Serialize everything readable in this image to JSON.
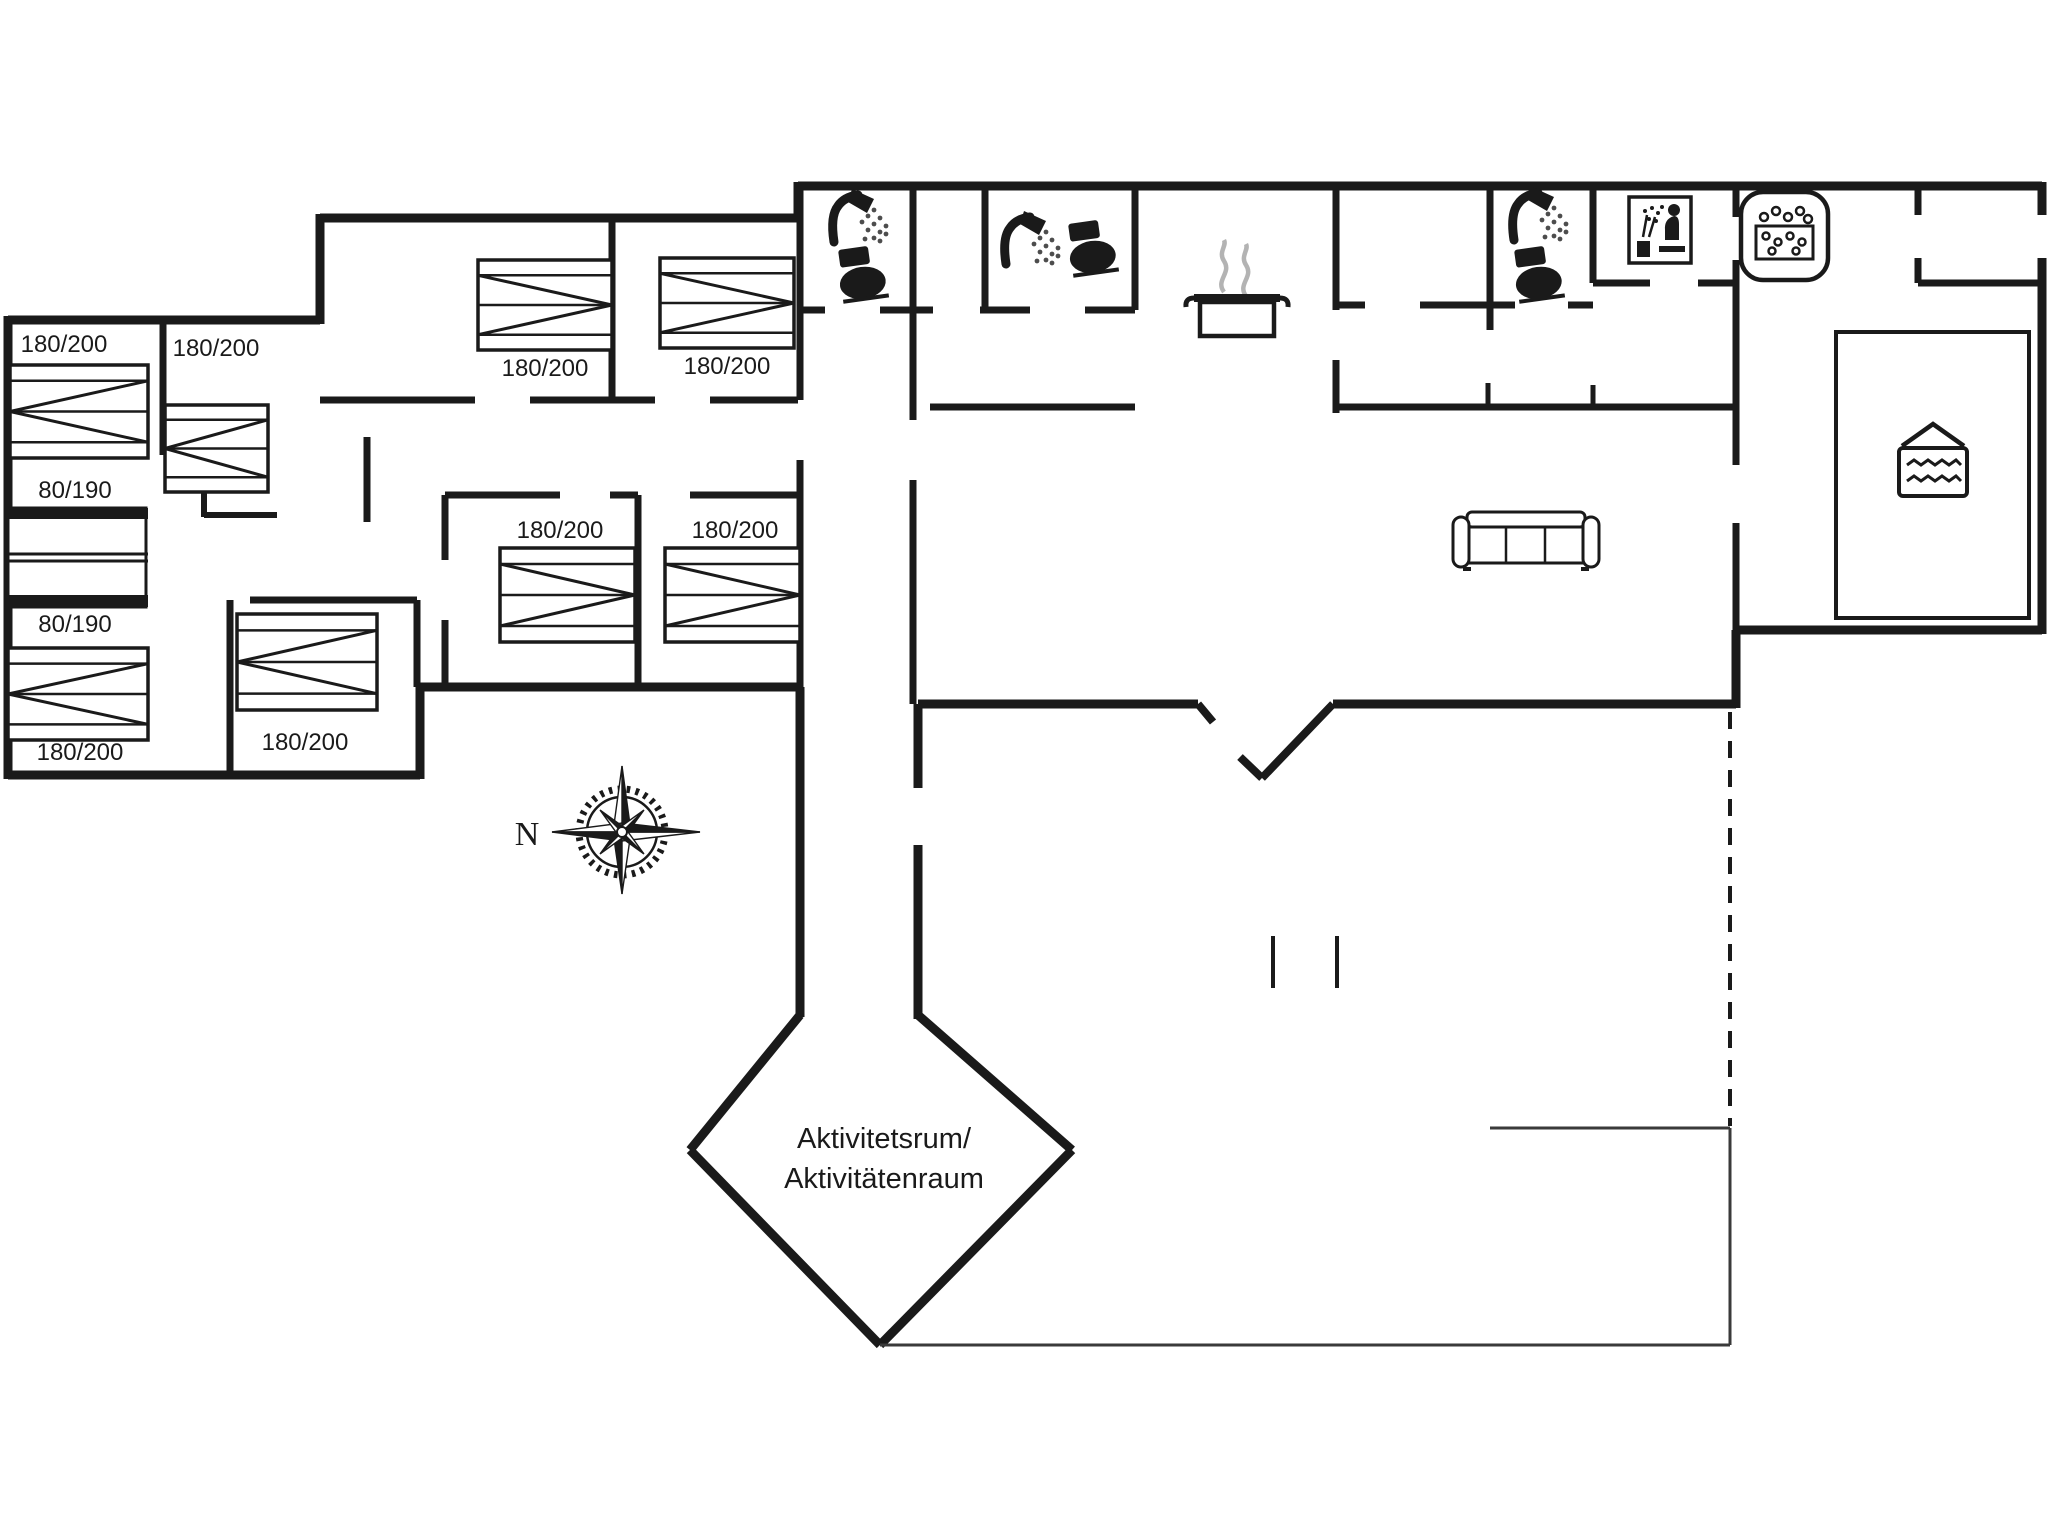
{
  "colors": {
    "ink": "#1a1a1a",
    "steam": "#b3b3b3",
    "spray": "#4d4d4d",
    "background": "#ffffff"
  },
  "labels": {
    "compass_north": "N",
    "activity_room": [
      "Aktivitetsrum/",
      "Aktivitätenraum"
    ],
    "bed_sizes": [
      {
        "text": "180/200",
        "x": 64,
        "y": 352
      },
      {
        "text": "180/200",
        "x": 216,
        "y": 356
      },
      {
        "text": "80/190",
        "x": 75,
        "y": 498
      },
      {
        "text": "80/190",
        "x": 75,
        "y": 632
      },
      {
        "text": "180/200",
        "x": 80,
        "y": 760
      },
      {
        "text": "180/200",
        "x": 305,
        "y": 750
      },
      {
        "text": "180/200",
        "x": 545,
        "y": 376
      },
      {
        "text": "180/200",
        "x": 727,
        "y": 374
      },
      {
        "text": "180/200",
        "x": 560,
        "y": 538
      },
      {
        "text": "180/200",
        "x": 735,
        "y": 538
      }
    ]
  },
  "icons": [
    {
      "name": "shower-icon",
      "x": 828,
      "y": 192
    },
    {
      "name": "toilet-icon",
      "x": 838,
      "y": 250
    },
    {
      "name": "shower-icon",
      "x": 1000,
      "y": 214
    },
    {
      "name": "toilet-icon",
      "x": 1068,
      "y": 224
    },
    {
      "name": "cooking-pot-icon",
      "x": 1192,
      "y": 240
    },
    {
      "name": "shower-icon",
      "x": 1508,
      "y": 190
    },
    {
      "name": "toilet-icon",
      "x": 1514,
      "y": 250
    },
    {
      "name": "sauna-icon",
      "x": 1629,
      "y": 197
    },
    {
      "name": "whirlpool-icon",
      "x": 1741,
      "y": 192
    },
    {
      "name": "pool-icon",
      "x": 1899,
      "y": 420
    },
    {
      "name": "sofa-icon",
      "x": 1455,
      "y": 512
    },
    {
      "name": "compass-rose-icon",
      "x": 622,
      "y": 832
    }
  ]
}
